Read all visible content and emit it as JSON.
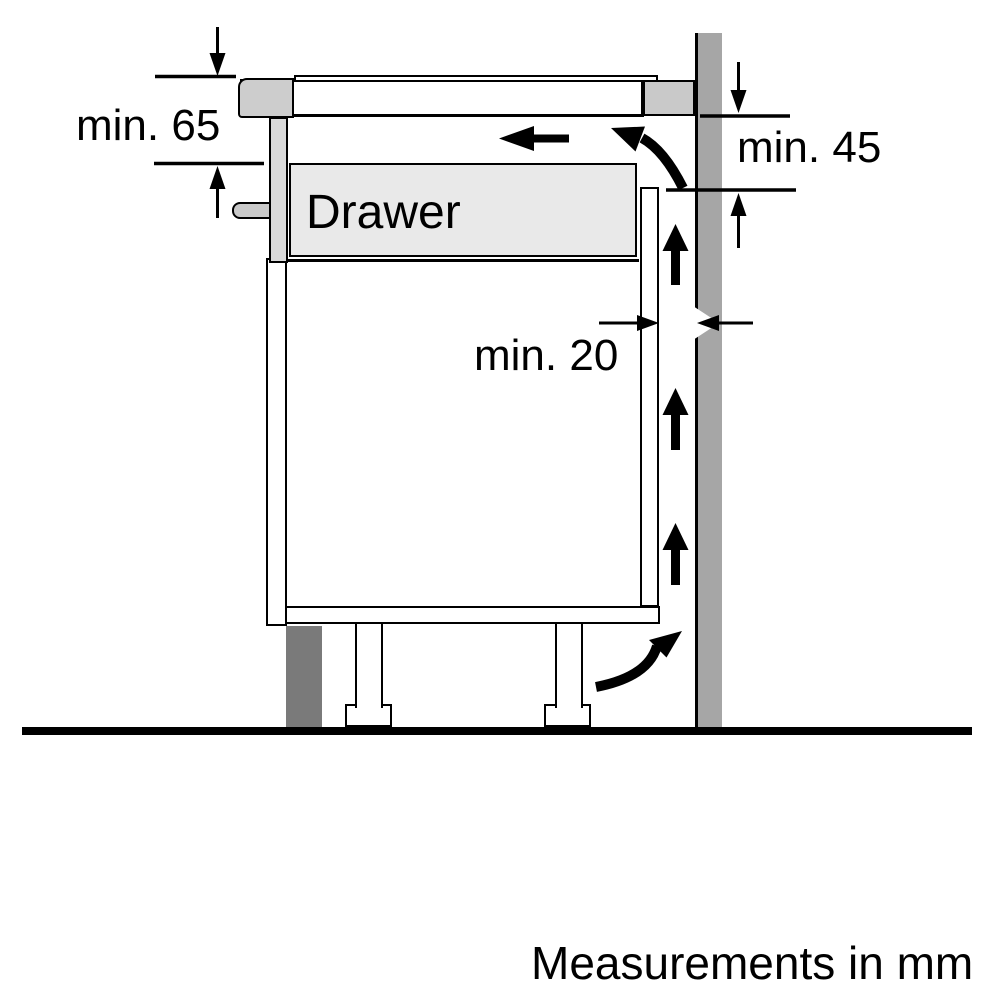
{
  "diagram": {
    "title": "Hob installation clearance side-view diagram",
    "labels": {
      "min_top_clearance": "min. 65",
      "min_rear_clearance": "min. 45",
      "min_wall_gap": "min. 20",
      "drawer": "Drawer",
      "units_note": "Measurements in mm"
    },
    "palette": {
      "line": "#000000",
      "background": "#ffffff",
      "wall_gray": "#a6a6a6",
      "plinth_gray": "#7a7a7a",
      "trim_gray": "#c9c9c9",
      "panel_gray": "#d9d9d9",
      "drawer_gray": "#e9e9e9"
    },
    "icons": {
      "dimension-arrow-icon": "solid black triangle with thin stem",
      "airflow-arrow-icon": "thick solid black straight/curved arrow"
    }
  }
}
